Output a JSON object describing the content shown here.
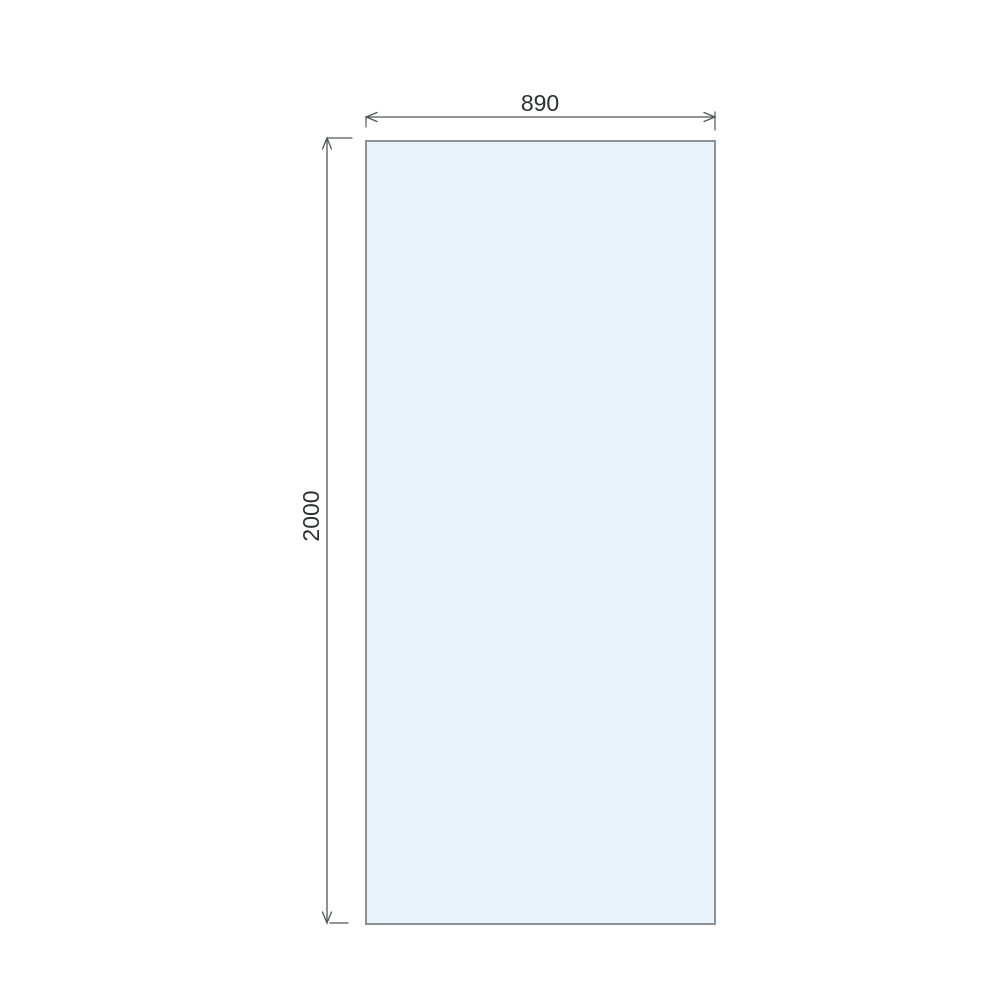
{
  "drawing": {
    "dimensions": {
      "width": {
        "label": "890"
      },
      "height": {
        "label": "2000"
      }
    },
    "colors": {
      "panel_fill": "#E8F2FB",
      "panel_border": "#8D9297",
      "dimension_line": "#53565A",
      "label_text": "#2E3033",
      "background": "#FFFFFF"
    }
  }
}
